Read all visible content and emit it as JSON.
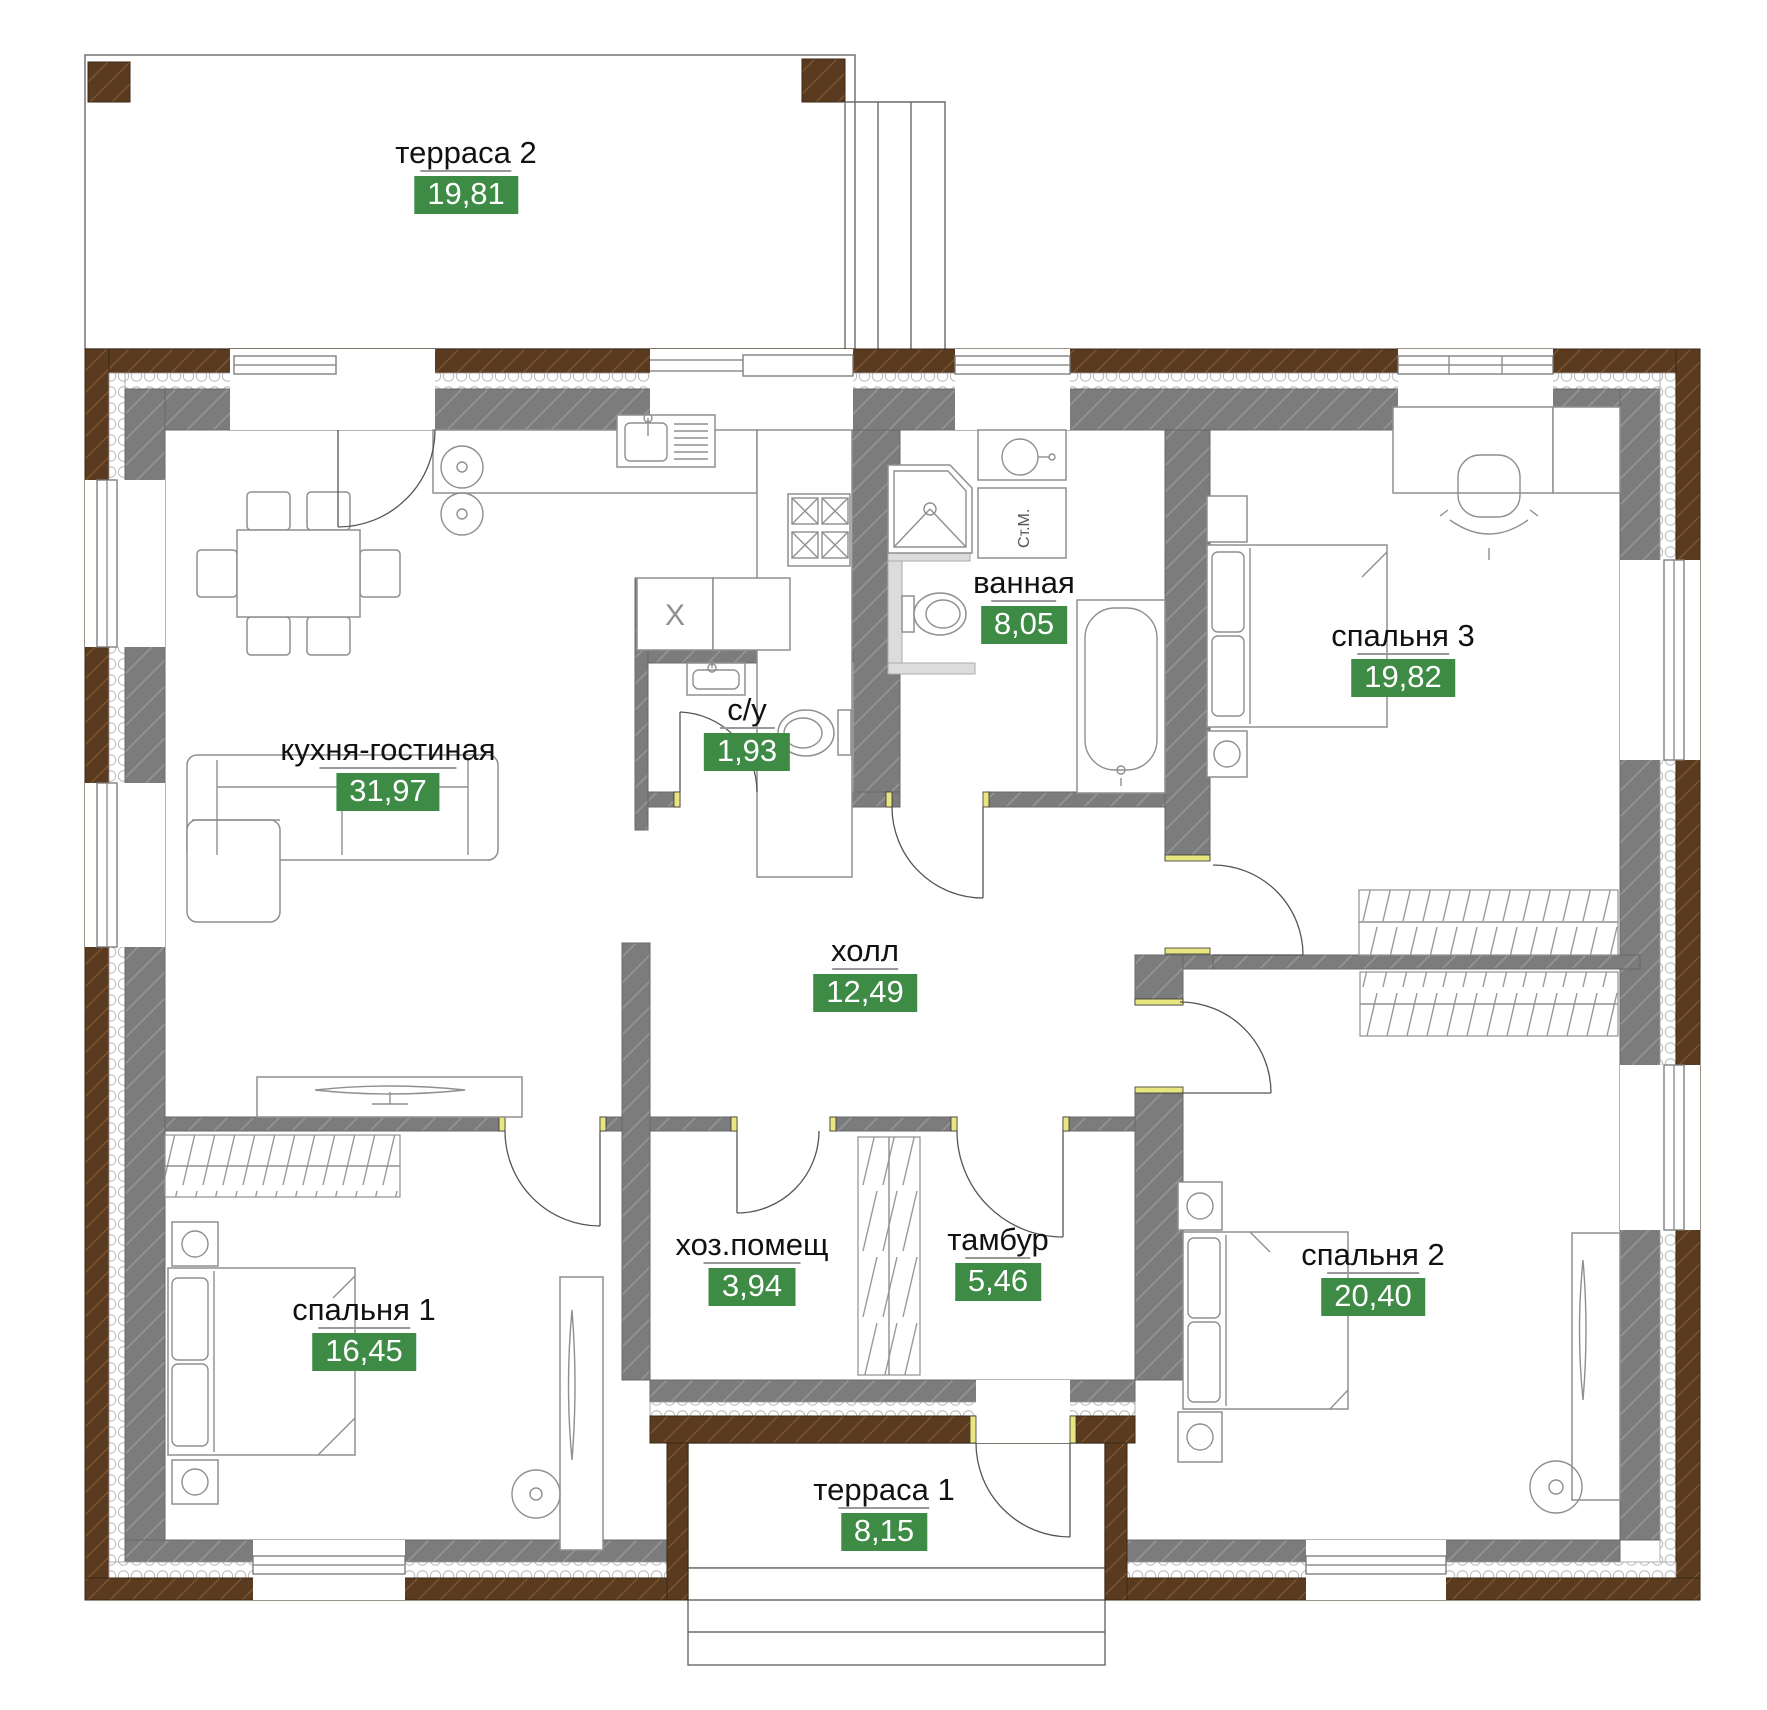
{
  "plan": {
    "rooms": [
      {
        "id": "terrace-2",
        "name": "терраса 2",
        "area": "19,81",
        "x": 466,
        "y": 136
      },
      {
        "id": "kitchen-living",
        "name": "кухня-гостиная",
        "area": "31,97",
        "x": 388,
        "y": 733
      },
      {
        "id": "wc",
        "name": "с/у",
        "area": "1,93",
        "x": 747,
        "y": 693
      },
      {
        "id": "bathroom",
        "name": "ванная",
        "area": "8,05",
        "x": 1024,
        "y": 566
      },
      {
        "id": "bedroom-3",
        "name": "спальня 3",
        "area": "19,82",
        "x": 1403,
        "y": 619
      },
      {
        "id": "hall",
        "name": "холл",
        "area": "12,49",
        "x": 865,
        "y": 934
      },
      {
        "id": "bedroom-1",
        "name": "спальня 1",
        "area": "16,45",
        "x": 364,
        "y": 1293
      },
      {
        "id": "utility",
        "name": "хоз.помещ",
        "area": "3,94",
        "x": 752,
        "y": 1228
      },
      {
        "id": "vestibule",
        "name": "тамбур",
        "area": "5,46",
        "x": 998,
        "y": 1223
      },
      {
        "id": "bedroom-2",
        "name": "спальня 2",
        "area": "20,40",
        "x": 1373,
        "y": 1238
      },
      {
        "id": "terrace-1",
        "name": "терраса 1",
        "area": "8,15",
        "x": 884,
        "y": 1473
      }
    ],
    "labels": {
      "washing_machine": "Ст.М.",
      "appliance": "X"
    },
    "colors": {
      "area_badge_green": "#3d8b45",
      "wall_brown": "#5b3b20",
      "wall_gray": "#7c7c7c",
      "insulation_white": "#ffffff",
      "door_end_yellow": "#e9e57f",
      "furniture_line": "#8f8f8f",
      "text": "#111111"
    }
  }
}
